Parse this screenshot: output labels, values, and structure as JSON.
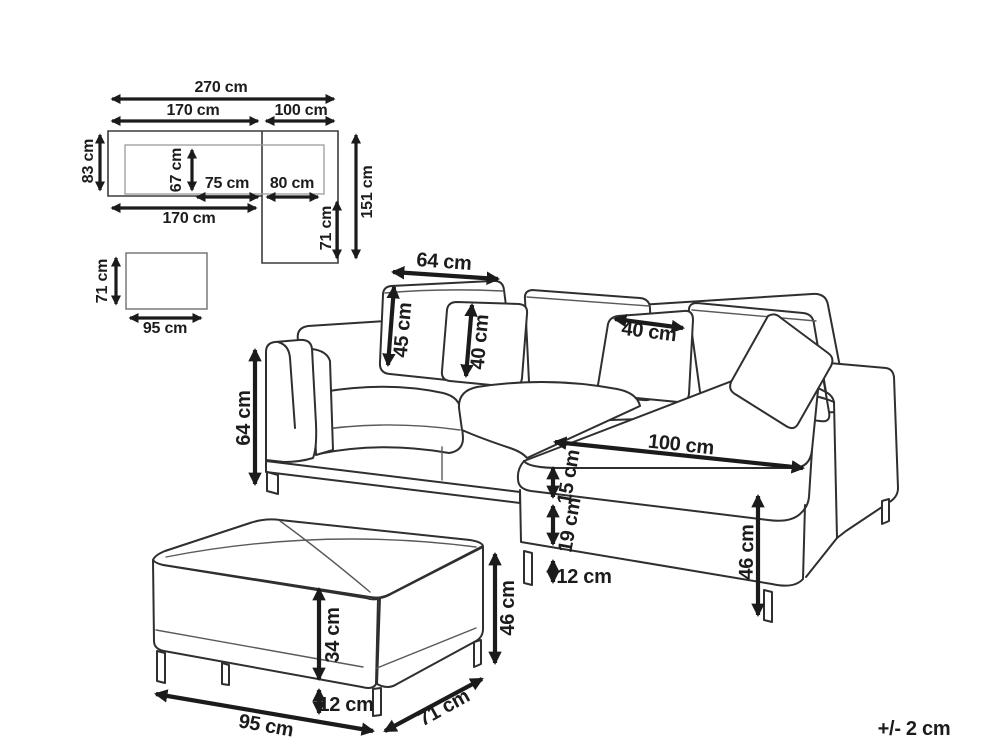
{
  "colors": {
    "background": "#ffffff",
    "line_art": "#2f2f2f",
    "dimension": "#1b1b1b"
  },
  "top_view": {
    "overall_width": "270 cm",
    "section_width": "170 cm",
    "chaise_width": "100 cm",
    "sofa_depth": "83 cm",
    "seat_depth": "67 cm",
    "seat_cushion_width": "75 cm",
    "chaise_cushion_width": "80 cm",
    "front_width": "170 cm",
    "chaise_extension_depth": "71 cm",
    "overall_depth": "151 cm"
  },
  "ottoman_top_view": {
    "depth": "71 cm",
    "width": "95 cm"
  },
  "sofa": {
    "back_cushion_width": "64 cm",
    "back_cushion_height": "45 cm",
    "pillow_left_size": "40 cm",
    "pillow_right_size": "40 cm",
    "armrest_height": "64 cm",
    "chaise_length": "100 cm",
    "seat_cushion_thickness": "15 cm",
    "base_height": "19 cm",
    "leg_height": "12 cm",
    "seat_height": "46 cm"
  },
  "ottoman": {
    "body_height": "34 cm",
    "leg_height": "12 cm",
    "overall_height": "46 cm",
    "width": "95 cm",
    "depth": "71 cm"
  },
  "footnote": {
    "tolerance": "+/- 2 cm"
  }
}
